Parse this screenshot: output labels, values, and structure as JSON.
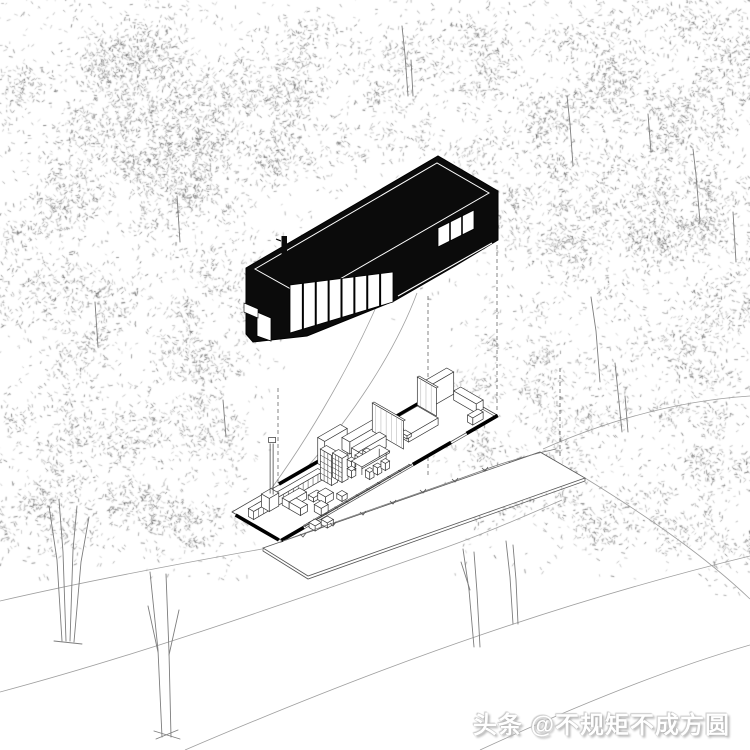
{
  "watermark": {
    "text": "头条 @不规矩不成方圆"
  },
  "colors": {
    "background": "#ffffff",
    "house_fill": "#0b0b0b",
    "line": "#2a2a2a",
    "contour": "#9f9f9f",
    "trunk": "#7d7d7d",
    "dashed": "#666666",
    "watermark_text": "#ffffff"
  },
  "scene": {
    "contours": [
      "M383,291 C352,365 300,455 248,519",
      "M417,293 C392,360 341,432 290,486",
      "M543,449 C620,415 690,400 750,396",
      "M585,478 C650,518 706,557 750,599",
      "M0,692 C150,652 300,598 430,553 C480,536 525,516 562,500",
      "M185,750 C330,688 520,612 750,556",
      "M480,750 C580,704 670,668 750,645",
      "M0,601 C100,578 200,560 262,549"
    ],
    "grass": {
      "path": "M283,541 C350,516 430,490 492,467 C515,459 538,453 556,449",
      "ticks": [
        [
          300,
          534
        ],
        [
          330,
          523
        ],
        [
          360,
          512
        ],
        [
          390,
          501
        ],
        [
          420,
          490
        ],
        [
          452,
          479
        ],
        [
          482,
          468
        ]
      ]
    },
    "trunks": [
      [
        [
          62,
          641
        ],
        [
          57,
          560
        ],
        [
          49,
          506
        ]
      ],
      [
        [
          66,
          641
        ],
        [
          63,
          552
        ],
        [
          59,
          500
        ]
      ],
      [
        [
          70,
          641
        ],
        [
          73,
          550
        ],
        [
          77,
          506
        ]
      ],
      [
        [
          74,
          642
        ],
        [
          81,
          562
        ],
        [
          89,
          517
        ]
      ],
      [
        [
          54,
          641
        ],
        [
          82,
          644
        ]
      ],
      [
        [
          162,
          737
        ],
        [
          158,
          650
        ],
        [
          150,
          572
        ]
      ],
      [
        [
          171,
          737
        ],
        [
          169,
          652
        ],
        [
          166,
          574
        ]
      ],
      [
        [
          158,
          652
        ],
        [
          148,
          606
        ]
      ],
      [
        [
          169,
          655
        ],
        [
          179,
          610
        ]
      ],
      [
        [
          154,
          731
        ],
        [
          180,
          739
        ]
      ],
      [
        [
          156,
          739
        ],
        [
          178,
          730
        ]
      ],
      [
        [
          474,
          647
        ],
        [
          469,
          590
        ],
        [
          463,
          549
        ]
      ],
      [
        [
          480,
          647
        ],
        [
          477,
          592
        ],
        [
          474,
          552
        ]
      ],
      [
        [
          513,
          624
        ],
        [
          510,
          577
        ],
        [
          506,
          541
        ]
      ],
      [
        [
          518,
          624
        ],
        [
          516,
          580
        ],
        [
          513,
          545
        ]
      ],
      [
        [
          470,
          590
        ],
        [
          461,
          562
        ]
      ],
      [
        [
          408,
          96
        ],
        [
          405,
          55
        ],
        [
          402,
          26
        ]
      ],
      [
        [
          413,
          96
        ],
        [
          411,
          60
        ]
      ],
      [
        [
          573,
          166
        ],
        [
          570,
          124
        ],
        [
          567,
          96
        ]
      ],
      [
        [
          651,
          152
        ],
        [
          648,
          114
        ]
      ],
      [
        [
          700,
          222
        ],
        [
          696,
          175
        ],
        [
          693,
          149
        ]
      ],
      [
        [
          622,
          432
        ],
        [
          618,
          392
        ],
        [
          615,
          363
        ]
      ],
      [
        [
          628,
          432
        ],
        [
          625,
          396
        ]
      ],
      [
        [
          736,
          262
        ],
        [
          733,
          212
        ]
      ],
      [
        [
          180,
          242
        ],
        [
          177,
          196
        ]
      ],
      [
        [
          98,
          347
        ],
        [
          95,
          302
        ]
      ],
      [
        [
          600,
          382
        ],
        [
          596,
          331
        ],
        [
          591,
          297
        ]
      ],
      [
        [
          226,
          437
        ],
        [
          223,
          400
        ]
      ]
    ],
    "dashed_verticals": [
      [
        278,
        388,
        538
      ],
      [
        428,
        296,
        475
      ],
      [
        497,
        245,
        410
      ],
      [
        560,
        368,
        458
      ]
    ],
    "deck": [
      [
        263,
        548
      ],
      [
        540,
        452
      ],
      [
        585,
        478
      ],
      [
        308,
        576
      ]
    ],
    "house": {
      "silhouette": [
        [
          246,
          268
        ],
        [
          438,
          156
        ],
        [
          498,
          191
        ],
        [
          498,
          240
        ],
        [
          455,
          266
        ],
        [
          394,
          301
        ],
        [
          307,
          336
        ],
        [
          253,
          342
        ],
        [
          246,
          334
        ]
      ],
      "roof_inset": [
        [
          255,
          269
        ],
        [
          437,
          163
        ],
        [
          489,
          193
        ],
        [
          307,
          298
        ]
      ],
      "notch": [
        [
          244,
          303
        ],
        [
          258,
          309
        ],
        [
          258,
          318
        ],
        [
          244,
          312
        ]
      ],
      "window_band": {
        "x1": 290,
        "x2": 393,
        "ytop1": 285,
        "ytop2": 272,
        "ybot1": 333,
        "ybot2": 302,
        "panes": 8
      },
      "wrap_pane": [
        [
          257,
          312
        ],
        [
          271,
          318
        ],
        [
          271,
          341
        ],
        [
          257,
          336
        ]
      ],
      "clerestory": {
        "poly": [
          [
            438,
            228
          ],
          [
            474,
            210
          ],
          [
            474,
            229
          ],
          [
            438,
            247
          ]
        ],
        "seps": [
          450,
          462
        ],
        "slope": -0.5
      },
      "reveal": [
        [
          398,
          296
        ],
        [
          492,
          243
        ]
      ],
      "chimney": {
        "x": 281.5,
        "y": 236,
        "w": 5.5,
        "h": 34
      },
      "chimney_tick": [
        [
          281,
          241
        ],
        [
          276,
          239
        ]
      ]
    },
    "plan": {
      "origin": [
        232,
        512
      ],
      "length": 250,
      "width": 56,
      "thick_walls": {
        "front": [
          [
            0,
            26
          ],
          [
            152,
            196
          ],
          [
            214,
            250
          ]
        ],
        "back": [
          [
            55,
            118
          ],
          [
            132,
            250
          ]
        ],
        "left": [
          [
            6,
            56
          ]
        ]
      },
      "glass": {
        "a1": 28,
        "a2": 150,
        "step": 12.2
      },
      "items": [
        [
          "box",
          98,
          1,
          26,
          8,
          26
        ],
        [
          "box",
          126,
          1,
          36,
          9,
          12
        ],
        [
          "box",
          218,
          2,
          28,
          8,
          22
        ],
        [
          "box",
          172,
          8,
          34,
          24,
          7
        ],
        [
          "box",
          174,
          12,
          5,
          7,
          3
        ],
        [
          "box",
          174,
          21,
          5,
          7,
          3
        ],
        [
          "box",
          240,
          16,
          8,
          26,
          9
        ],
        [
          "wall",
          214,
          0,
          22,
          28
        ],
        [
          "wall",
          162,
          0,
          36,
          28
        ],
        [
          "box",
          122,
          16,
          32,
          8,
          11
        ],
        [
          "shelf",
          5,
          14,
          80,
          6,
          8,
          14
        ],
        [
          "grid",
          84,
          18,
          7,
          13,
          30
        ],
        [
          "grid",
          93,
          23,
          7,
          11,
          24
        ],
        [
          "fire",
          22,
          12,
          11,
          9,
          13
        ],
        [
          "box",
          112,
          21,
          5,
          5,
          7
        ],
        [
          "box",
          121,
          21,
          5,
          5,
          7
        ],
        [
          "box",
          130,
          21,
          5,
          5,
          7
        ],
        [
          "box",
          103,
          30,
          5,
          5,
          7
        ],
        [
          "table",
          110,
          28,
          32,
          12,
          10
        ],
        [
          "box",
          112,
          42,
          5,
          5,
          7
        ],
        [
          "box",
          121,
          42,
          5,
          5,
          7
        ],
        [
          "box",
          130,
          42,
          5,
          5,
          7
        ],
        [
          "box",
          36,
          22,
          20,
          8,
          7
        ],
        [
          "box",
          36,
          30,
          8,
          13,
          7
        ],
        [
          "box",
          57,
          31,
          10,
          6,
          4
        ],
        [
          "box",
          62,
          37,
          9,
          9,
          7
        ],
        [
          "box",
          74,
          47,
          6,
          6,
          5
        ],
        [
          "box",
          48,
          47,
          8,
          8,
          7
        ],
        [
          "box",
          226,
          46,
          12,
          6,
          7
        ],
        [
          "box",
          29,
          60,
          7,
          7,
          5
        ],
        [
          "box",
          39,
          64,
          7,
          7,
          5
        ]
      ]
    },
    "foliage": {
      "blobs": [
        [
          60,
          70,
          130,
          90,
          900
        ],
        [
          200,
          90,
          120,
          95,
          800
        ],
        [
          330,
          60,
          100,
          70,
          420
        ],
        [
          440,
          55,
          90,
          60,
          380
        ],
        [
          560,
          70,
          110,
          85,
          700
        ],
        [
          680,
          60,
          110,
          80,
          700
        ],
        [
          720,
          160,
          80,
          90,
          500
        ],
        [
          620,
          150,
          90,
          80,
          480
        ],
        [
          90,
          200,
          120,
          90,
          780
        ],
        [
          220,
          200,
          90,
          80,
          450
        ],
        [
          160,
          130,
          90,
          80,
          500
        ],
        [
          40,
          320,
          80,
          90,
          420
        ],
        [
          120,
          330,
          80,
          70,
          330
        ],
        [
          60,
          440,
          75,
          70,
          350
        ],
        [
          150,
          430,
          60,
          55,
          220
        ],
        [
          215,
          340,
          70,
          70,
          340
        ],
        [
          210,
          430,
          60,
          60,
          230
        ],
        [
          680,
          260,
          85,
          80,
          480
        ],
        [
          590,
          260,
          70,
          60,
          300
        ],
        [
          660,
          370,
          80,
          75,
          420
        ],
        [
          720,
          440,
          60,
          70,
          300
        ],
        [
          560,
          420,
          75,
          65,
          330
        ],
        [
          600,
          500,
          70,
          55,
          280
        ],
        [
          500,
          480,
          65,
          55,
          250
        ],
        [
          470,
          420,
          60,
          50,
          220
        ],
        [
          110,
          515,
          110,
          50,
          420
        ],
        [
          30,
          510,
          70,
          45,
          240
        ],
        [
          200,
          530,
          60,
          35,
          160
        ],
        [
          390,
          120,
          60,
          45,
          180
        ],
        [
          300,
          150,
          70,
          50,
          220
        ],
        [
          480,
          180,
          60,
          60,
          220
        ],
        [
          540,
          210,
          70,
          60,
          260
        ],
        [
          530,
          330,
          60,
          50,
          180
        ],
        [
          240,
          280,
          60,
          50,
          240
        ],
        [
          735,
          300,
          50,
          60,
          250
        ],
        [
          680,
          520,
          60,
          40,
          180
        ],
        [
          740,
          560,
          40,
          40,
          120
        ]
      ],
      "scatter": [
        [
          0,
          750,
          0,
          320,
          700
        ],
        [
          0,
          250,
          320,
          580,
          250
        ],
        [
          450,
          750,
          320,
          580,
          250
        ]
      ]
    }
  }
}
